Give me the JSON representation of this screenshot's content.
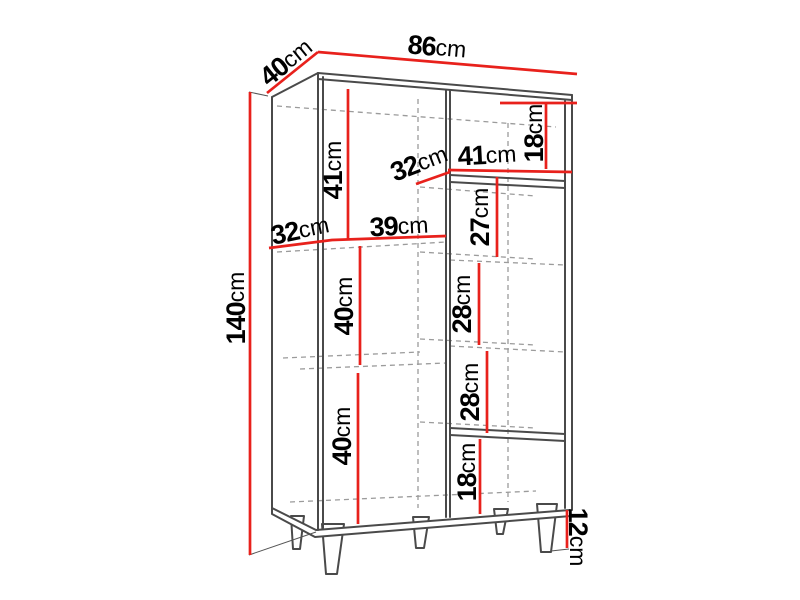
{
  "diagram": {
    "type": "furniture dimension drawing",
    "subject": "open shelving cabinet (bookcase) on tapered legs, perspective line drawing",
    "unit": "cm",
    "overall_dimensions": {
      "width": 86,
      "depth": 40,
      "height": 140,
      "leg_height": 12
    },
    "colors": {
      "dimension_line": "#e8211c",
      "body_line": "#4a4a4a",
      "hidden_line": "#9b9b9b",
      "text": "#000000",
      "background": "#ffffff"
    },
    "dimensions": [
      {
        "name": "top-depth",
        "num": "40",
        "unit": "cm",
        "x": 286,
        "y": 62,
        "rot": -39
      },
      {
        "name": "top-width",
        "num": "86",
        "unit": "cm",
        "x": 437,
        "y": 47,
        "rot": 5
      },
      {
        "name": "side-height",
        "num": "140",
        "unit": "cm",
        "x": 236,
        "y": 308,
        "rot": -90
      },
      {
        "name": "left-top-opening",
        "num": "41",
        "unit": "cm",
        "x": 333,
        "y": 170,
        "rot": -90
      },
      {
        "name": "left-shelf-depth",
        "num": "32",
        "unit": "cm",
        "x": 300,
        "y": 230,
        "rot": -12
      },
      {
        "name": "left-shelf-width",
        "num": "39",
        "unit": "cm",
        "x": 399,
        "y": 226,
        "rot": -3
      },
      {
        "name": "right-shelf-depth",
        "num": "32",
        "unit": "cm",
        "x": 419,
        "y": 163,
        "rot": -21
      },
      {
        "name": "right-shelf-width",
        "num": "41",
        "unit": "cm",
        "x": 487,
        "y": 155,
        "rot": -3
      },
      {
        "name": "right-top-gap",
        "num": "18",
        "unit": "cm",
        "x": 534,
        "y": 133,
        "rot": -90
      },
      {
        "name": "right-opening-1",
        "num": "27",
        "unit": "cm",
        "x": 480,
        "y": 217,
        "rot": -90
      },
      {
        "name": "left-middle-opening",
        "num": "40",
        "unit": "cm",
        "x": 344,
        "y": 306,
        "rot": -90
      },
      {
        "name": "right-opening-2",
        "num": "28",
        "unit": "cm",
        "x": 462,
        "y": 304,
        "rot": -90
      },
      {
        "name": "right-opening-3",
        "num": "28",
        "unit": "cm",
        "x": 470,
        "y": 392,
        "rot": -90
      },
      {
        "name": "left-bottom-opening",
        "num": "40",
        "unit": "cm",
        "x": 342,
        "y": 436,
        "rot": -90
      },
      {
        "name": "right-bottom-gap",
        "num": "18",
        "unit": "cm",
        "x": 467,
        "y": 472,
        "rot": -90
      },
      {
        "name": "leg-height",
        "num": "12",
        "unit": "cm",
        "x": 578,
        "y": 537,
        "rot": 90
      }
    ]
  }
}
